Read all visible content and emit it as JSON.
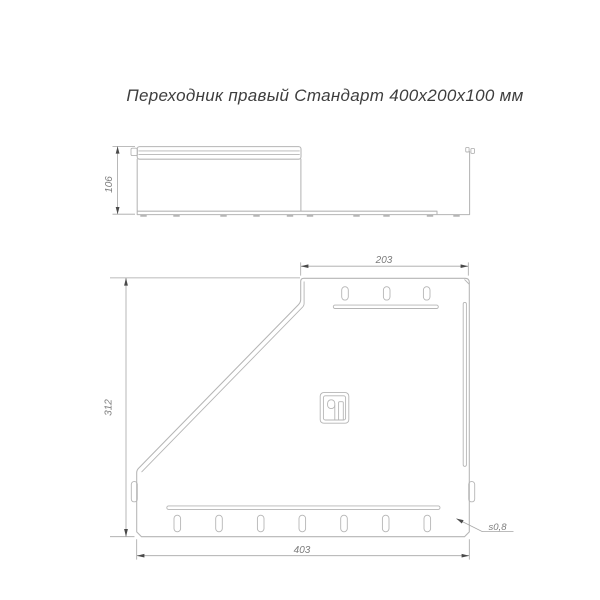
{
  "title": "Переходник правый Стандарт 400х200х100 мм",
  "side_view": {
    "name": "side elevation view",
    "height_dim": "106"
  },
  "plan_view": {
    "name": "plan view",
    "top_width_dim": "203",
    "side_height_dim": "312",
    "bottom_width_dim": "403",
    "thickness_label": "s0,8",
    "top_slot_count": 3,
    "bottom_slot_count": 7
  },
  "logo": {
    "icon": "manufacturer-stamp-icon"
  },
  "colors": {
    "background": "#ffffff",
    "part_line": "#b5b5b5",
    "dim_line": "#a6a6a6",
    "dim_text": "#7c7c7c",
    "arrow": "#4a4a4a",
    "title_text": "#3e3e3e"
  }
}
